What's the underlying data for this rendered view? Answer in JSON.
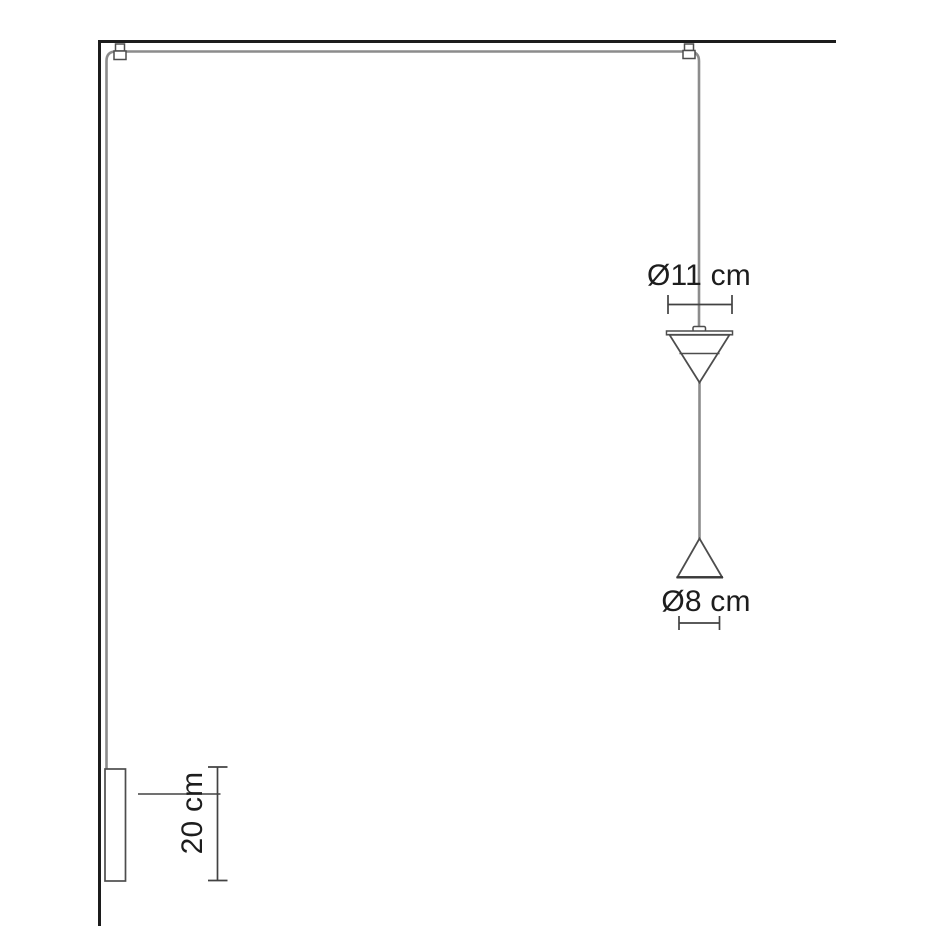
{
  "labels": {
    "upper_shade_diameter": "Ø11 cm",
    "lower_shade_diameter": "Ø8 cm",
    "wall_tube_length": "20 cm"
  },
  "dimensions": {
    "upper_shade_diameter_cm": 11,
    "lower_shade_diameter_cm": 8,
    "wall_tube_length_cm": 20
  },
  "colors": {
    "background": "#ffffff",
    "structure_line": "#1c1c1c",
    "cable": "#8c8c8c",
    "fixture_outline": "#4d4d4d",
    "shade_base_line": "#3a3a3a",
    "dimension_line": "#424242",
    "text": "#1d1d1d"
  }
}
